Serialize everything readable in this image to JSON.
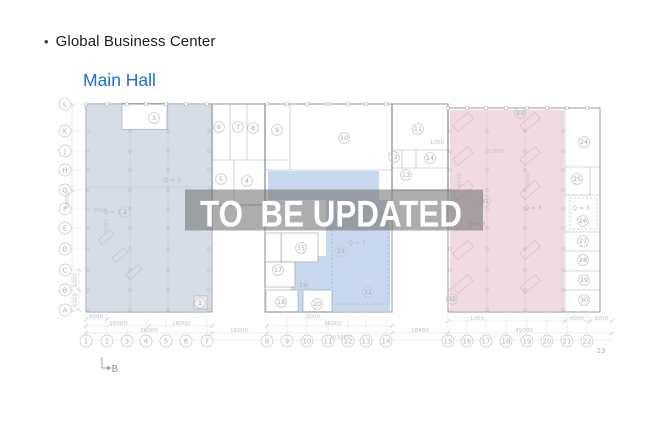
{
  "header": {
    "bullet": "•",
    "title": "Global Business Center",
    "subtitle": "Main Hall"
  },
  "overlay": {
    "text": "TO  BE UPDATED"
  },
  "colors": {
    "left_zone": "#d6dde6",
    "middle_zone": "#c9d8ef",
    "right_zone": "#f0dbe3",
    "overlay_band": "rgba(113,113,116,0.58)",
    "overlay_text": "#ffffff",
    "link": "#1b6ed2",
    "title_text": "#1d1d1f"
  },
  "plan": {
    "row_axis": [
      {
        "label": "L",
        "x": 65,
        "y": 104
      },
      {
        "label": "K",
        "x": 65,
        "y": 131
      },
      {
        "label": "J",
        "x": 65,
        "y": 151
      },
      {
        "label": "H",
        "x": 65,
        "y": 170
      },
      {
        "label": "G",
        "x": 65,
        "y": 190
      },
      {
        "label": "F",
        "x": 65,
        "y": 209
      },
      {
        "label": "E",
        "x": 65,
        "y": 228
      },
      {
        "label": "D",
        "x": 65,
        "y": 249
      },
      {
        "label": "C",
        "x": 65,
        "y": 270
      },
      {
        "label": "B",
        "x": 65,
        "y": 290
      },
      {
        "label": "A",
        "x": 65,
        "y": 310
      }
    ],
    "col_axis_y": 341,
    "col_axis": [
      {
        "label": "1",
        "x": 86
      },
      {
        "label": "2",
        "x": 107
      },
      {
        "label": "3",
        "x": 127
      },
      {
        "label": "4",
        "x": 146
      },
      {
        "label": "5",
        "x": 166
      },
      {
        "label": "6",
        "x": 186
      },
      {
        "label": "7",
        "x": 207
      },
      {
        "label": "8",
        "x": 267
      },
      {
        "label": "9",
        "x": 287
      },
      {
        "label": "10",
        "x": 307
      },
      {
        "label": "11",
        "x": 328
      },
      {
        "label": "12",
        "x": 348
      },
      {
        "label": "13",
        "x": 366
      },
      {
        "label": "14",
        "x": 386
      },
      {
        "label": "15",
        "x": 448
      },
      {
        "label": "16",
        "x": 467
      },
      {
        "label": "17",
        "x": 486
      },
      {
        "label": "18",
        "x": 506
      },
      {
        "label": "19",
        "x": 527
      },
      {
        "label": "20",
        "x": 547
      },
      {
        "label": "21",
        "x": 567
      },
      {
        "label": "22",
        "x": 587
      }
    ],
    "col_23": {
      "label": "23",
      "x": 601,
      "y": 353
    },
    "rooms": [
      {
        "n": "1",
        "x": 200,
        "y": 303
      },
      {
        "n": "2",
        "x": 125,
        "y": 212
      },
      {
        "n": "3",
        "x": 154,
        "y": 118
      },
      {
        "n": "4",
        "x": 247,
        "y": 181
      },
      {
        "n": "5",
        "x": 221,
        "y": 179
      },
      {
        "n": "6",
        "x": 219,
        "y": 127
      },
      {
        "n": "7",
        "x": 238,
        "y": 127
      },
      {
        "n": "8",
        "x": 253,
        "y": 128
      },
      {
        "n": "9",
        "x": 277,
        "y": 130
      },
      {
        "n": "10",
        "x": 344,
        "y": 138
      },
      {
        "n": "11",
        "x": 418,
        "y": 129
      },
      {
        "n": "12",
        "x": 394,
        "y": 157
      },
      {
        "n": "13",
        "x": 406,
        "y": 175
      },
      {
        "n": "14",
        "x": 430,
        "y": 158
      },
      {
        "n": "15",
        "x": 301,
        "y": 248
      },
      {
        "n": "17",
        "x": 278,
        "y": 270
      },
      {
        "n": "18",
        "x": 281,
        "y": 302
      },
      {
        "n": "19",
        "x": 303,
        "y": 285
      },
      {
        "n": "20",
        "x": 317,
        "y": 304
      },
      {
        "n": "21",
        "x": 341,
        "y": 251
      },
      {
        "n": "22",
        "x": 368,
        "y": 292
      },
      {
        "n": "23",
        "x": 520,
        "y": 113
      },
      {
        "n": "24",
        "x": 584,
        "y": 142
      },
      {
        "n": "25",
        "x": 577,
        "y": 179
      },
      {
        "n": "26",
        "x": 583,
        "y": 221
      },
      {
        "n": "27",
        "x": 583,
        "y": 241
      },
      {
        "n": "28",
        "x": 583,
        "y": 260
      },
      {
        "n": "29",
        "x": 584,
        "y": 280
      },
      {
        "n": "30",
        "x": 584,
        "y": 300
      },
      {
        "n": "31",
        "x": 485,
        "y": 201
      },
      {
        "n": "32",
        "x": 452,
        "y": 299
      }
    ],
    "dims": [
      {
        "t": "6000",
        "x": 96,
        "y": 318
      },
      {
        "t": "2000",
        "x": 313,
        "y": 318
      },
      {
        "t": "1000",
        "x": 477,
        "y": 320
      },
      {
        "t": "6000",
        "x": 577,
        "y": 320
      },
      {
        "t": "3000",
        "x": 601,
        "y": 320
      },
      {
        "t": "18000",
        "x": 118,
        "y": 325
      },
      {
        "t": "18000",
        "x": 181,
        "y": 325
      },
      {
        "t": "36000",
        "x": 333,
        "y": 325
      },
      {
        "t": "36000",
        "x": 149,
        "y": 332
      },
      {
        "t": "16000",
        "x": 239,
        "y": 332
      },
      {
        "t": "18400",
        "x": 420,
        "y": 332
      },
      {
        "t": "45000",
        "x": 524,
        "y": 332
      },
      {
        "t": "153660",
        "x": 340,
        "y": 339
      },
      {
        "t": "60000",
        "x": 69,
        "y": 200,
        "rot": 1
      },
      {
        "t": "6000",
        "x": 77,
        "y": 280,
        "rot": 1
      },
      {
        "t": "6000",
        "x": 77,
        "y": 300,
        "rot": 1
      },
      {
        "t": "2000",
        "x": 100,
        "y": 212
      },
      {
        "t": "3000",
        "x": 108,
        "y": 226,
        "rot": 1
      },
      {
        "t": "1000",
        "x": 437,
        "y": 144
      },
      {
        "t": "1800",
        "x": 497,
        "y": 153
      },
      {
        "t": "6000",
        "x": 461,
        "y": 180,
        "rot": 1
      },
      {
        "t": "6000",
        "x": 530,
        "y": 180,
        "rot": 1
      }
    ],
    "zone_labels": [
      {
        "t": "Q = 3",
        "x": 172,
        "y": 182
      },
      {
        "t": "Q = 3",
        "x": 112,
        "y": 214
      },
      {
        "t": "Q = 3",
        "x": 357,
        "y": 245
      },
      {
        "t": "Q = 3",
        "x": 477,
        "y": 226
      },
      {
        "t": "Q = 3",
        "x": 533,
        "y": 210
      },
      {
        "t": "Q = 3",
        "x": 581,
        "y": 210
      }
    ],
    "marker_b": {
      "label": "B"
    }
  }
}
